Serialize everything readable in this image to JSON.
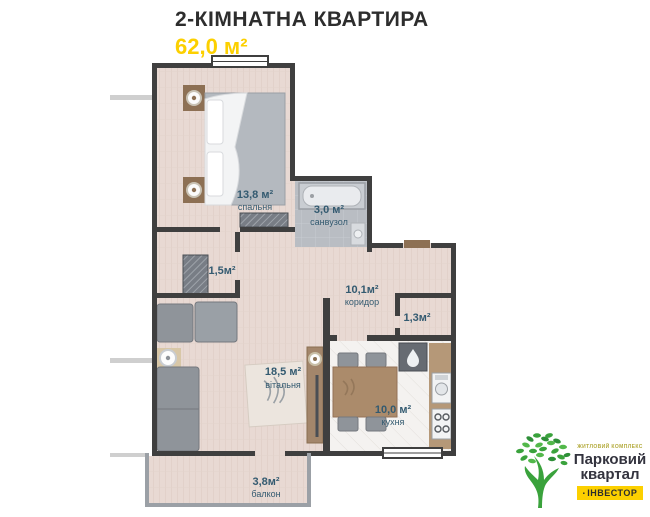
{
  "header": {
    "title": "2-КІМНАТНА КВАРТИРА",
    "area": "62,0 м²"
  },
  "badge": {
    "rooms": "2",
    "area_live": "32,3",
    "area_total": "62,0"
  },
  "rooms": [
    {
      "id": "bedroom",
      "area": "13,8 м²",
      "name": "спальня"
    },
    {
      "id": "bathroom",
      "area": "3,0 м²",
      "name": "санвузол"
    },
    {
      "id": "closet",
      "area": "1,5м²",
      "name": ""
    },
    {
      "id": "corridor",
      "area": "10,1м²",
      "name": "коридор"
    },
    {
      "id": "storage",
      "area": "1,3м²",
      "name": ""
    },
    {
      "id": "living",
      "area": "18,5 м²",
      "name": "вітальня"
    },
    {
      "id": "kitchen",
      "area": "10,0 м²",
      "name": "кухня"
    },
    {
      "id": "balcony",
      "area": "3,8м²",
      "name": "балкон"
    }
  ],
  "logo": {
    "complex_type": "ЖИТЛОВИЙ КОМПЛЕКС",
    "brand_line1": "Парковий",
    "brand_line2": "квартал",
    "developer_mark": "▪",
    "developer": "ІНВЕСТОР"
  },
  "icons": {
    "building_locator": "stepped-building-footprint",
    "tree": "green-tree",
    "fridge_drop": "water-drop"
  },
  "colors": {
    "accent_yellow": "#fcd000",
    "title_dark": "#2d2d2d",
    "label_blue": "#335a70",
    "wall_dark": "#3f3f3f",
    "logo_green": "#3aa23c",
    "floor_pink": "#e8d9d3",
    "floor_bath_grey": "#b9bdc3"
  }
}
